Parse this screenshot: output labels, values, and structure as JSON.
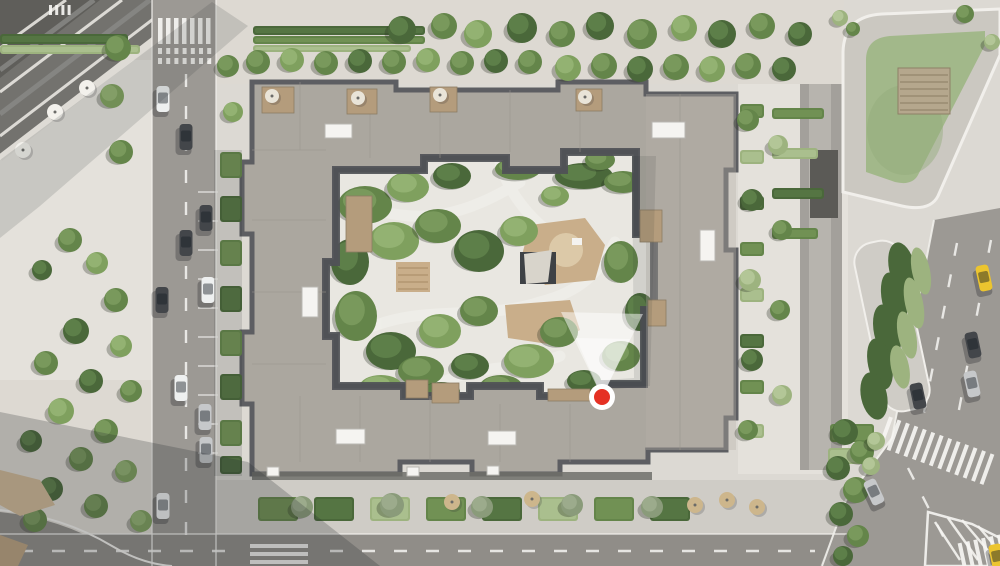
{
  "scene": {
    "description": "aerial-masterplan-render-of-residential-courtyard-block",
    "marker_tooltip": ""
  },
  "colors": {
    "pavement": "#dcd9d3",
    "plaza": "#e4e1db",
    "plaza_warm": "#ddd9d2",
    "road": "#9c9994",
    "road_dark": "#908d88",
    "lane_gray": "#a3a09b",
    "lane_center": "#b7b4ae",
    "curb": "#f1efeb",
    "white_mark": "#f6f5f2",
    "sidewalk": "#cfccc6",
    "roof": "#aba79f",
    "roof_light": "#b6b2aa",
    "roof_edge": "#5d5e62",
    "roof_inner": "#4f5155",
    "roof_line": "#98948c",
    "arcade": "#6f6e6a",
    "skylight": "#f5f4f1",
    "wood": "#b49c7c",
    "wood_dark": "#8d7c63",
    "deck": "#b5a78d",
    "deck_line": "#93866c",
    "courtyard": "#e9e7e1",
    "path_light": "#f0efea",
    "playground": "#c9ae8a",
    "sand": "#dcc9a8",
    "pavilion": "#3e4145",
    "canopy_top": "#d8d4cb",
    "lawn": "#a2b88a",
    "lawn_dark": "#93aa7b",
    "ring": "#cbc8c1",
    "dark_roof_tl": "#73726e",
    "dark_roof_tl2": "#5f5e5a",
    "tan_bldg": "#a8977e",
    "tan_bldg2": "#97856c",
    "shadow": "rgba(38,40,44,0.24)",
    "shadow_soft": "rgba(38,40,44,0.14)",
    "tree_shadow": "rgba(40,46,34,0.30)",
    "marker_red": "#e53124",
    "marker_ring": "#ffffff",
    "cone_white": "#ffffff",
    "fence": "#8f8d88",
    "tree_tones": {
      "dark": [
        "#4a683a",
        "#5d7f49"
      ],
      "mid": [
        "#64854a",
        "#79995c"
      ],
      "light": [
        "#7fa05e",
        "#93b272"
      ],
      "pale": [
        "#9db37f",
        "#b3c697"
      ],
      "gray": [
        "#8a9b7a",
        "#9cab8c"
      ]
    },
    "car_colors": {
      "white": "#eef0f0",
      "dark": "#43464a",
      "silver": "#c6c8ca",
      "taxi": "#ecc52f"
    }
  },
  "marker": {
    "x": 602,
    "y": 397,
    "r_outer": 13,
    "r_inner": 8
  },
  "cone": {
    "outer": "602,397 561,312 643,314",
    "inner": "602,397 576,338 630,339"
  },
  "trees": [
    [
      118,
      48,
      13,
      "mid"
    ],
    [
      112,
      96,
      12,
      "light"
    ],
    [
      121,
      152,
      12,
      "mid"
    ],
    [
      70,
      240,
      12,
      "mid"
    ],
    [
      97,
      263,
      11,
      "light"
    ],
    [
      42,
      270,
      10,
      "dark"
    ],
    [
      116,
      300,
      12,
      "mid"
    ],
    [
      76,
      331,
      13,
      "dark"
    ],
    [
      121,
      346,
      11,
      "light"
    ],
    [
      46,
      363,
      12,
      "mid"
    ],
    [
      91,
      381,
      12,
      "dark"
    ],
    [
      131,
      391,
      11,
      "mid"
    ],
    [
      61,
      411,
      13,
      "light"
    ],
    [
      106,
      431,
      12,
      "mid"
    ],
    [
      31,
      441,
      11,
      "dark"
    ],
    [
      81,
      459,
      12,
      "mid"
    ],
    [
      126,
      471,
      11,
      "light"
    ],
    [
      51,
      489,
      12,
      "dark"
    ],
    [
      96,
      506,
      12,
      "mid"
    ],
    [
      141,
      521,
      11,
      "light"
    ],
    [
      35,
      520,
      12,
      "mid"
    ],
    [
      228,
      66,
      11,
      "mid"
    ],
    [
      233,
      112,
      10,
      "light"
    ],
    [
      258,
      62,
      12,
      "mid"
    ],
    [
      292,
      60,
      12,
      "light"
    ],
    [
      326,
      63,
      12,
      "mid"
    ],
    [
      360,
      61,
      12,
      "dark"
    ],
    [
      394,
      62,
      12,
      "mid"
    ],
    [
      428,
      60,
      12,
      "light"
    ],
    [
      462,
      63,
      12,
      "mid"
    ],
    [
      496,
      61,
      12,
      "dark"
    ],
    [
      530,
      62,
      12,
      "mid"
    ],
    [
      568,
      68,
      13,
      "light"
    ],
    [
      604,
      66,
      13,
      "mid"
    ],
    [
      640,
      69,
      13,
      "dark"
    ],
    [
      676,
      67,
      13,
      "mid"
    ],
    [
      712,
      69,
      13,
      "light"
    ],
    [
      748,
      66,
      13,
      "mid"
    ],
    [
      784,
      69,
      12,
      "dark"
    ],
    [
      402,
      30,
      14,
      "dark"
    ],
    [
      444,
      26,
      13,
      "mid"
    ],
    [
      478,
      34,
      14,
      "light"
    ],
    [
      522,
      28,
      15,
      "dark"
    ],
    [
      562,
      34,
      13,
      "mid"
    ],
    [
      600,
      26,
      14,
      "dark"
    ],
    [
      642,
      34,
      15,
      "mid"
    ],
    [
      684,
      28,
      13,
      "light"
    ],
    [
      722,
      34,
      14,
      "dark"
    ],
    [
      762,
      26,
      13,
      "mid"
    ],
    [
      800,
      34,
      12,
      "dark"
    ],
    [
      748,
      120,
      11,
      "mid"
    ],
    [
      778,
      145,
      10,
      "pale"
    ],
    [
      752,
      200,
      11,
      "dark"
    ],
    [
      782,
      230,
      10,
      "mid"
    ],
    [
      750,
      280,
      11,
      "pale"
    ],
    [
      780,
      310,
      10,
      "mid"
    ],
    [
      752,
      360,
      11,
      "dark"
    ],
    [
      782,
      395,
      10,
      "pale"
    ],
    [
      748,
      430,
      10,
      "mid"
    ],
    [
      845,
      432,
      13,
      "dark"
    ],
    [
      862,
      452,
      12,
      "mid"
    ],
    [
      838,
      468,
      12,
      "dark"
    ],
    [
      856,
      490,
      13,
      "mid"
    ],
    [
      841,
      514,
      12,
      "dark"
    ],
    [
      858,
      536,
      11,
      "mid"
    ],
    [
      843,
      556,
      10,
      "dark"
    ],
    [
      876,
      441,
      9,
      "pale"
    ],
    [
      871,
      466,
      9,
      "pale"
    ],
    [
      302,
      507,
      11,
      "gray"
    ],
    [
      392,
      505,
      12,
      "gray"
    ],
    [
      482,
      507,
      11,
      "gray"
    ],
    [
      572,
      505,
      11,
      "gray"
    ],
    [
      652,
      507,
      11,
      "gray"
    ],
    [
      840,
      18,
      8,
      "pale"
    ],
    [
      853,
      29,
      7,
      "mid"
    ],
    [
      965,
      14,
      9,
      "mid"
    ],
    [
      992,
      42,
      8,
      "pale"
    ]
  ],
  "canopies": [
    [
      365,
      205,
      27,
      19,
      "mid"
    ],
    [
      408,
      187,
      21,
      15,
      "light"
    ],
    [
      452,
      176,
      19,
      13,
      "dark"
    ],
    [
      518,
      169,
      23,
      11,
      "mid"
    ],
    [
      584,
      176,
      29,
      13,
      "dark"
    ],
    [
      623,
      182,
      19,
      11,
      "mid"
    ],
    [
      350,
      262,
      19,
      23,
      "dark"
    ],
    [
      394,
      241,
      25,
      19,
      "light"
    ],
    [
      438,
      226,
      23,
      17,
      "mid"
    ],
    [
      479,
      251,
      25,
      21,
      "dark"
    ],
    [
      519,
      231,
      19,
      15,
      "light"
    ],
    [
      621,
      262,
      17,
      21,
      "mid"
    ],
    [
      640,
      312,
      15,
      19,
      "dark"
    ],
    [
      621,
      356,
      19,
      15,
      "mid"
    ],
    [
      356,
      316,
      21,
      25,
      "mid"
    ],
    [
      391,
      351,
      25,
      19,
      "dark"
    ],
    [
      440,
      331,
      21,
      17,
      "light"
    ],
    [
      479,
      311,
      19,
      15,
      "mid"
    ],
    [
      421,
      371,
      23,
      15,
      "mid"
    ],
    [
      470,
      366,
      19,
      13,
      "dark"
    ],
    [
      529,
      361,
      25,
      17,
      "light"
    ],
    [
      559,
      332,
      19,
      15,
      "mid"
    ],
    [
      584,
      381,
      17,
      11,
      "dark"
    ],
    [
      501,
      386,
      21,
      11,
      "mid"
    ],
    [
      441,
      391,
      19,
      9,
      "dark"
    ],
    [
      381,
      386,
      21,
      11,
      "light"
    ],
    [
      600,
      160,
      15,
      10,
      "mid"
    ],
    [
      555,
      196,
      14,
      10,
      "light"
    ]
  ],
  "hedges": [
    [
      253,
      26,
      172,
      9,
      "dark"
    ],
    [
      253,
      36,
      172,
      8,
      "mid"
    ],
    [
      253,
      45,
      158,
      7,
      "pale"
    ],
    [
      0,
      34,
      128,
      10,
      "dark"
    ],
    [
      0,
      45,
      140,
      9,
      "pale"
    ],
    [
      220,
      152,
      22,
      26,
      "mid"
    ],
    [
      220,
      196,
      22,
      26,
      "dark"
    ],
    [
      220,
      240,
      22,
      26,
      "mid"
    ],
    [
      220,
      286,
      22,
      26,
      "dark"
    ],
    [
      220,
      330,
      22,
      26,
      "mid"
    ],
    [
      220,
      374,
      22,
      26,
      "dark"
    ],
    [
      220,
      420,
      22,
      26,
      "mid"
    ],
    [
      220,
      456,
      22,
      18,
      "dark"
    ],
    [
      772,
      108,
      52,
      11,
      "mid"
    ],
    [
      772,
      148,
      46,
      11,
      "pale"
    ],
    [
      772,
      188,
      52,
      11,
      "dark"
    ],
    [
      772,
      228,
      46,
      11,
      "mid"
    ],
    [
      740,
      104,
      24,
      14,
      "mid"
    ],
    [
      740,
      150,
      24,
      14,
      "pale"
    ],
    [
      740,
      196,
      24,
      14,
      "dark"
    ],
    [
      740,
      242,
      24,
      14,
      "mid"
    ],
    [
      740,
      288,
      24,
      14,
      "pale"
    ],
    [
      740,
      334,
      24,
      14,
      "dark"
    ],
    [
      740,
      380,
      24,
      14,
      "mid"
    ],
    [
      740,
      424,
      24,
      14,
      "pale"
    ],
    [
      258,
      497,
      40,
      24,
      "mid"
    ],
    [
      314,
      497,
      40,
      24,
      "dark"
    ],
    [
      370,
      497,
      40,
      24,
      "pale"
    ],
    [
      426,
      497,
      40,
      24,
      "mid"
    ],
    [
      482,
      497,
      40,
      24,
      "dark"
    ],
    [
      538,
      497,
      40,
      24,
      "pale"
    ],
    [
      594,
      497,
      40,
      24,
      "mid"
    ],
    [
      650,
      497,
      40,
      24,
      "dark"
    ],
    [
      830,
      424,
      44,
      18,
      "mid"
    ],
    [
      828,
      448,
      40,
      16,
      "pale"
    ]
  ],
  "median_hedges": {
    "dark": [
      [
        902,
        268,
        13,
        26
      ],
      [
        894,
        300,
        12,
        28
      ],
      [
        887,
        332,
        13,
        28
      ],
      [
        880,
        364,
        12,
        26
      ],
      [
        874,
        396,
        13,
        24
      ]
    ],
    "pale": [
      [
        921,
        271,
        9,
        24
      ],
      [
        914,
        303,
        9,
        26
      ],
      [
        907,
        335,
        9,
        24
      ],
      [
        900,
        367,
        9,
        22
      ]
    ],
    "angle": -12
  },
  "cars": [
    [
      163,
      99,
      "white",
      0
    ],
    [
      186,
      137,
      "dark",
      0
    ],
    [
      206,
      218,
      "dark",
      0
    ],
    [
      186,
      243,
      "dark",
      0
    ],
    [
      208,
      290,
      "white",
      0
    ],
    [
      162,
      300,
      "dark",
      0
    ],
    [
      181,
      388,
      "white",
      0
    ],
    [
      205,
      417,
      "silver",
      0
    ],
    [
      206,
      450,
      "silver",
      0
    ],
    [
      163,
      506,
      "white",
      0
    ],
    [
      984,
      278,
      "taxi",
      -12
    ],
    [
      973,
      345,
      "dark",
      -12
    ],
    [
      972,
      384,
      "silver",
      -12
    ],
    [
      918,
      396,
      "dark",
      -12
    ],
    [
      874,
      492,
      "silver",
      -25
    ],
    [
      997,
      557,
      "taxi",
      -12
    ]
  ],
  "skylights": [
    [
      325,
      124,
      27,
      14
    ],
    [
      652,
      122,
      33,
      16
    ],
    [
      700,
      230,
      15,
      31
    ],
    [
      302,
      287,
      16,
      30
    ],
    [
      336,
      429,
      29,
      15
    ],
    [
      488,
      431,
      28,
      14
    ],
    [
      267,
      467,
      12,
      9
    ],
    [
      407,
      467,
      12,
      9
    ],
    [
      487,
      466,
      12,
      9
    ]
  ],
  "terraces": [
    [
      262,
      87,
      32,
      26
    ],
    [
      347,
      89,
      30,
      25
    ],
    [
      430,
      87,
      27,
      25
    ],
    [
      576,
      89,
      26,
      22
    ],
    [
      346,
      196,
      26,
      56
    ],
    [
      640,
      210,
      22,
      32
    ],
    [
      648,
      300,
      18,
      26
    ],
    [
      406,
      380,
      22,
      18
    ],
    [
      432,
      383,
      27,
      20
    ],
    [
      548,
      389,
      42,
      12
    ]
  ],
  "umbrellas": {
    "cafe": {
      "color": "#f3f1ec",
      "r": 8,
      "pts": [
        [
          87,
          88
        ],
        [
          55,
          112
        ],
        [
          23,
          150
        ]
      ]
    },
    "terrace": {
      "color": "#cdb68c",
      "r": 8,
      "pts": [
        [
          452,
          502
        ],
        [
          532,
          499
        ],
        [
          695,
          505
        ],
        [
          727,
          500
        ],
        [
          757,
          507
        ]
      ]
    },
    "roof": {
      "color": "#e9e4d8",
      "r": 7,
      "pts": [
        [
          272,
          96
        ],
        [
          358,
          98
        ],
        [
          440,
          95
        ],
        [
          585,
          97
        ]
      ]
    }
  },
  "crosswalks": {
    "left_top": {
      "x": 158,
      "y": 18,
      "count": 7,
      "w": 4.5,
      "gap": 3.5,
      "h": 26
    },
    "stop_row_a": {
      "x": 158,
      "y": 48,
      "count": 7,
      "w": 4,
      "gap": 4.2,
      "h": 6
    },
    "stop_row_b": {
      "x": 158,
      "y": 58,
      "count": 7,
      "w": 4,
      "gap": 4.2,
      "h": 6
    },
    "mini_top": {
      "x": 49,
      "y": 5,
      "count": 4,
      "w": 3,
      "gap": 3.2,
      "h": 10
    },
    "bottom": {
      "x": 250,
      "y": 544,
      "count": 3,
      "w": 58,
      "gap": 4,
      "h": 4,
      "horizontal": true
    },
    "right_upper": {
      "rot": 20,
      "cx": 940,
      "cy": 452,
      "x0": 880,
      "y": 436,
      "count": 13,
      "w": 4,
      "gap": 5,
      "h": 32
    },
    "right_lower": {
      "rot": -12,
      "cx": 985,
      "cy": 552,
      "x0": 960,
      "y": 538,
      "count": 6,
      "w": 4,
      "gap": 4,
      "h": 28
    }
  },
  "lane_dashes": [
    [
      186,
      74,
      186,
      536
    ],
    [
      20,
      551,
      235,
      551
    ],
    [
      330,
      551,
      815,
      551
    ],
    [
      957,
      243,
      921,
      428
    ],
    [
      991,
      240,
      958,
      415
    ],
    [
      908,
      468,
      945,
      540
    ]
  ],
  "parking_ticks": {
    "x1": 198,
    "x2": 218,
    "y0": 192,
    "step": 29,
    "count": 10
  },
  "chevron_lines": [
    [
      935,
      522,
      960,
      560
    ],
    [
      948,
      518,
      978,
      560
    ],
    [
      962,
      520,
      996,
      560
    ],
    [
      978,
      526,
      1000,
      552
    ]
  ]
}
